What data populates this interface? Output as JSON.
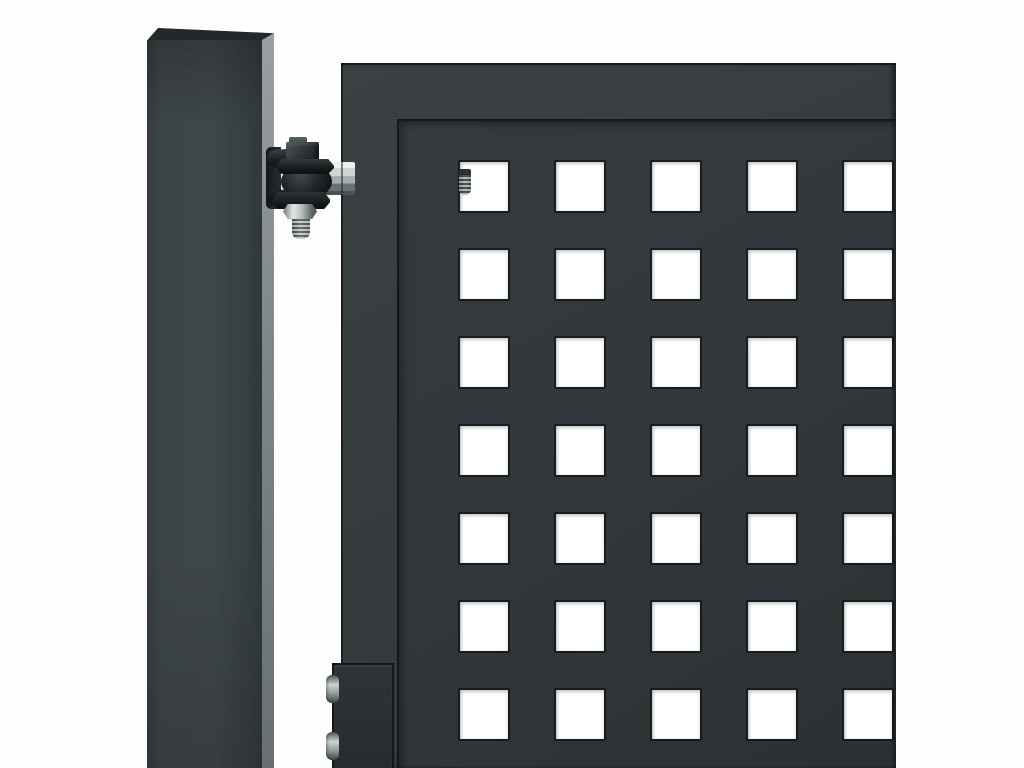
{
  "scene": {
    "width": 1024,
    "height": 768,
    "subject": "anthracite-metal-gate-with-square-post-and-ball-hinge"
  },
  "colors": {
    "background": "#fefefe",
    "post-top": "#23282a",
    "post-face-light": "#3e4547",
    "post-face-dark": "#31383a",
    "post-side-light": "#9aa0a0",
    "post-side-dark": "#687071",
    "frame-light": "#3b4143",
    "frame-dark": "#2e3436",
    "panel-light": "#353b3d",
    "panel-dark": "#2b3133",
    "edge-line": "#14181a",
    "hole": "#ffffff",
    "black-hardware-hi": "#4e5658",
    "metal-light": "#eef1f1",
    "metal-mid": "#a7aeae",
    "plate-light": "#2f3537",
    "plate-dark": "#262c2e"
  },
  "perforation_grid": {
    "cols": 5,
    "rows": 7,
    "x0": 460,
    "y0": 162,
    "pitch_x": 96,
    "pitch_y": 88,
    "hole_w": 48,
    "hole_h": 49
  }
}
